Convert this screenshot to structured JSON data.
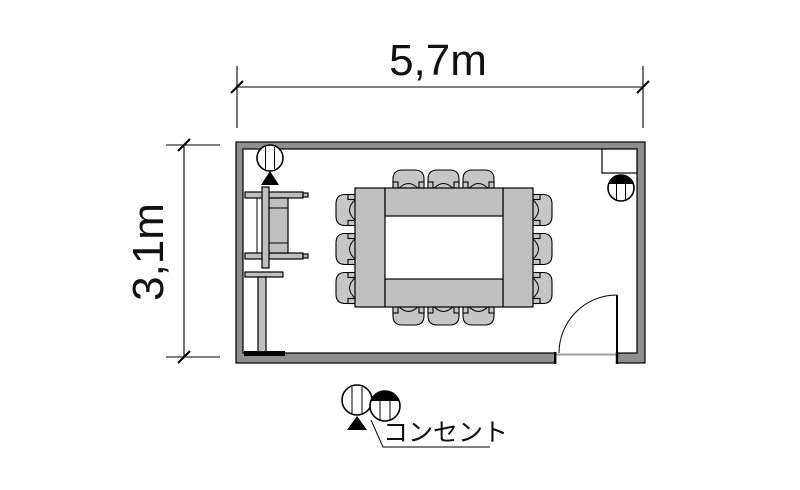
{
  "dimensions": {
    "width_label": "5,7m",
    "height_label": "3,1m",
    "width_m": 5.7,
    "height_m": 3.1
  },
  "legend": {
    "label": "コンセント",
    "symbols": [
      "floor-outlet-symbol",
      "wall-outlet-symbol"
    ]
  },
  "room": {
    "furniture": [
      "conference-table",
      "chairs-x12",
      "av-cart",
      "screen-partition"
    ],
    "fixtures": [
      "door-bottom-right",
      "wall-recess-top-right",
      "outlet-top-left",
      "outlet-top-right"
    ]
  },
  "colors": {
    "wall": "#8e8e8e",
    "furniture": "#bfbfbf",
    "chair": "#c6c6c6",
    "threshold": "#a0a0a0",
    "background": "#ffffff"
  }
}
